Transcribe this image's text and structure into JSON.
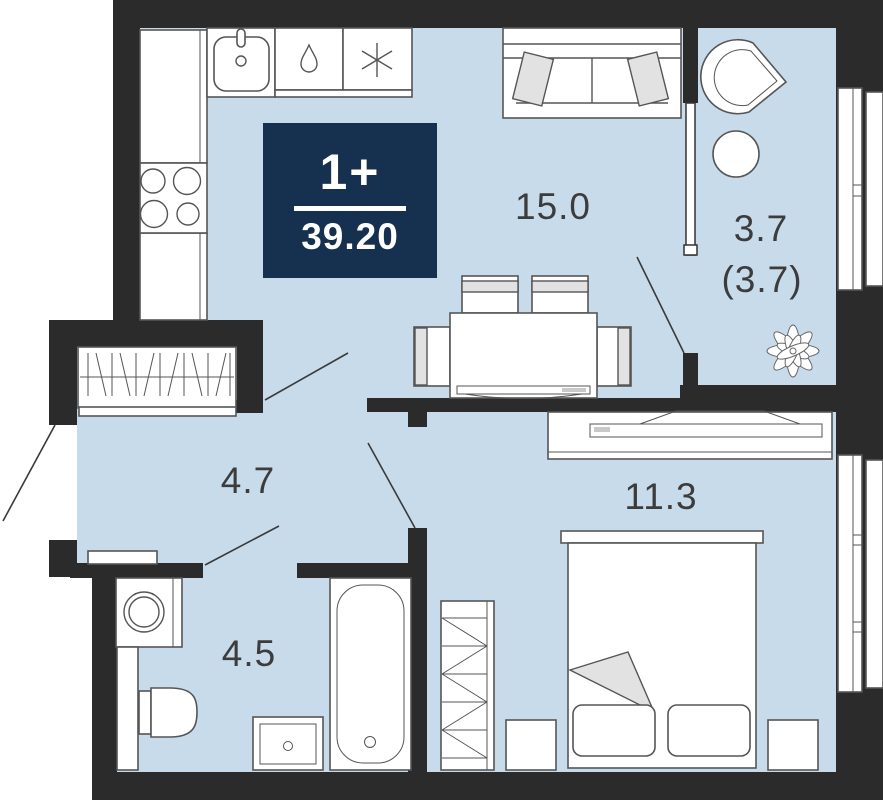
{
  "title": "1-room apartment floor plan",
  "badge": {
    "type": "1+",
    "area": "39.20"
  },
  "rooms": {
    "living": {
      "label": "15.0"
    },
    "balcony": {
      "label": "3.7",
      "label_alt": "(3.7)"
    },
    "hallway": {
      "label": "4.7"
    },
    "bathroom": {
      "label": "4.5"
    },
    "bedroom": {
      "label": "11.3"
    }
  },
  "colors": {
    "wall": "#2b2b2b",
    "floor": "#c7dbeb",
    "badge": "#16304f",
    "badge-text": "#ffffff",
    "line": "#555555",
    "label": "#3c3c3c",
    "accent": "#e2e2e2"
  },
  "icons": {
    "kitchen": [
      "sink-icon",
      "droplet-icon",
      "snowflake-icon",
      "stove-burners-icon"
    ],
    "balcony": [
      "fan-chair-icon",
      "round-table-icon",
      "plant-icon"
    ]
  }
}
